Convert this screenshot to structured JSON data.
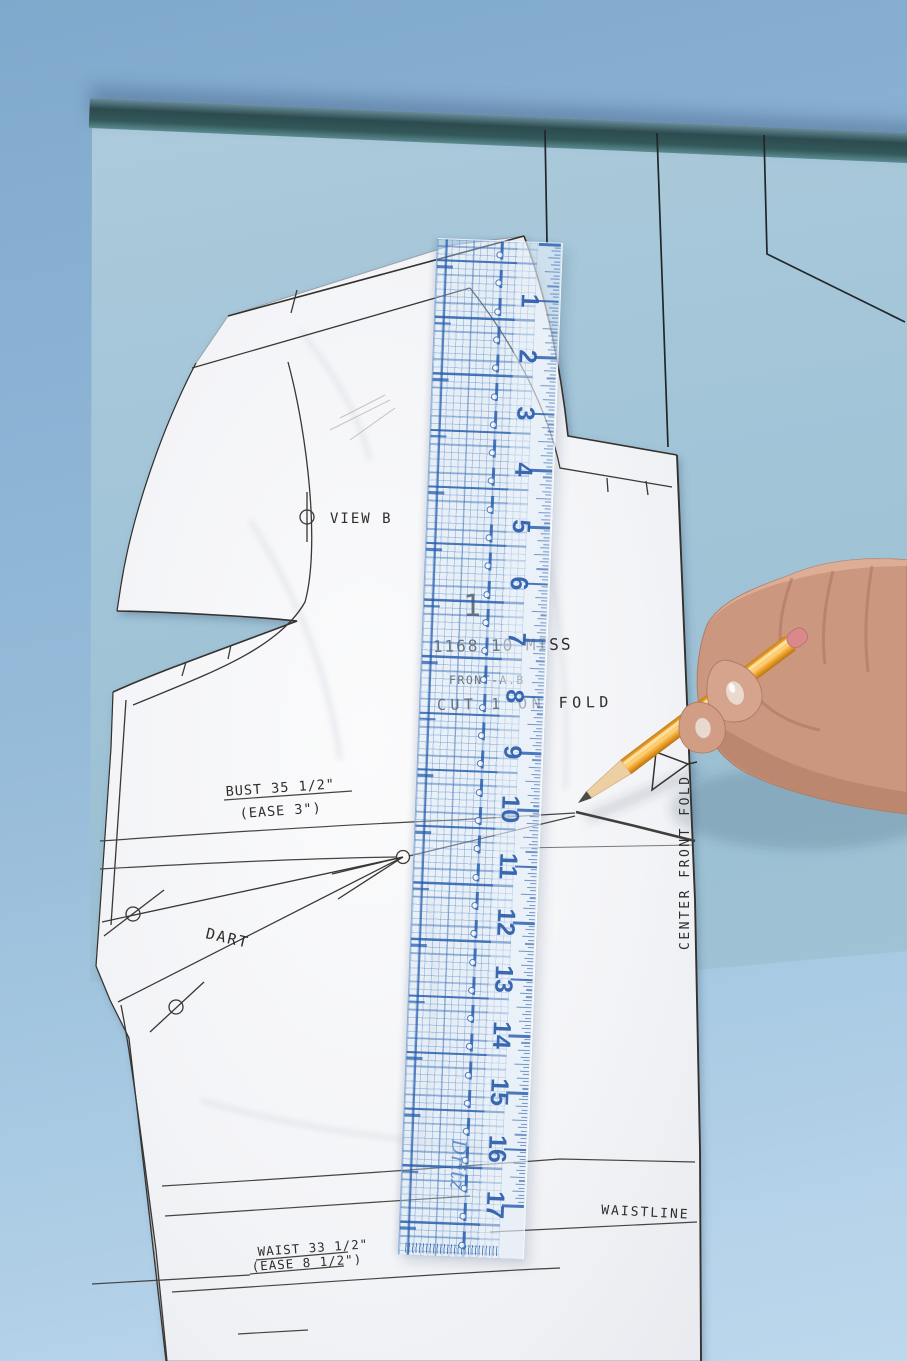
{
  "scene": {
    "description": "Hand drawing a waist alteration line across a sewing pattern front piece at the 10-inch mark of a clear gridded ruler"
  },
  "pattern_labels": {
    "view": "VIEW B",
    "piece_number": "1",
    "style_number": "1168 10 MISS",
    "piece_name": "FRONT-A.B",
    "cutting": "CUT 1 ON FOLD",
    "bust": "BUST 35 1/2\"",
    "bust_ease": "(EASE 3\")",
    "dart": "DART",
    "center_front": "CENTER FRONT FOLD",
    "waistline": "WAISTLINE",
    "waist": "WAIST 33 1/2\"",
    "waist_ease": "(EASE 8 1/2\")"
  },
  "ruler": {
    "brand": "Dritz",
    "numbers": [
      "1",
      "2",
      "3",
      "4",
      "5",
      "6",
      "7",
      "8",
      "9",
      "10",
      "11",
      "12",
      "13",
      "14",
      "15",
      "16",
      "17"
    ],
    "inch_px": 56.6,
    "ticks_per_inch": 16,
    "accent_color": "#2b5dab"
  },
  "colors": {
    "background_blue": "#8fb6d6",
    "tissue_blue": "#a3c5d8",
    "tissue_edge_teal": "#2c4b4e",
    "paper_white": "#f5f6f8",
    "ruler_grid_blue": "#3a6fb5",
    "pencil_orange": "#eda233",
    "eraser_pink": "#d9898c",
    "skin": "#cc977f",
    "print_black": "#2e2c2a"
  }
}
